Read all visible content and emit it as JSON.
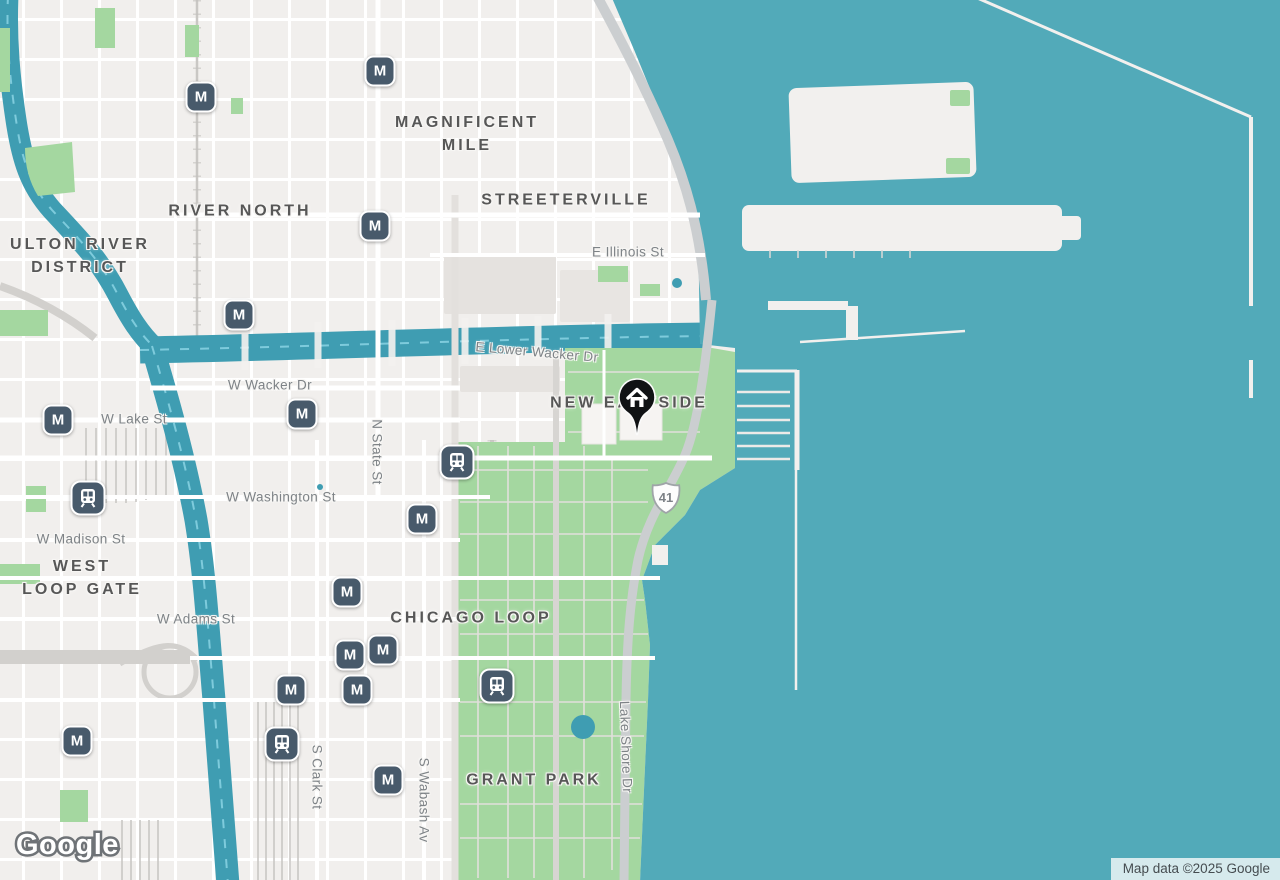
{
  "map": {
    "watermark": "Google",
    "attribution": "Map data ©2025 Google",
    "route_shield": "41",
    "icons": {
      "metro_glyph": "M"
    },
    "labels": {
      "neighborhoods": [
        {
          "text": "MAGNIFICENT\nMILE"
        },
        {
          "text": "RIVER NORTH"
        },
        {
          "text": "ULTON RIVER\nDISTRICT"
        },
        {
          "text": "STREETERVILLE"
        },
        {
          "text": "NEW EASTSIDE"
        },
        {
          "text": "WEST\nLOOP GATE"
        },
        {
          "text": "CHICAGO LOOP"
        },
        {
          "text": "GRANT PARK"
        }
      ],
      "streets": [
        {
          "text": "E Illinois St"
        },
        {
          "text": "E Lower Wacker Dr"
        },
        {
          "text": "W Wacker Dr"
        },
        {
          "text": "W Lake St"
        },
        {
          "text": "N State St"
        },
        {
          "text": "W Washington St"
        },
        {
          "text": "W Madison St"
        },
        {
          "text": "W Adams St"
        },
        {
          "text": "S Clark St"
        },
        {
          "text": "S Wabash Av"
        },
        {
          "text": "Lake Shore Dr"
        }
      ]
    },
    "colors": {
      "water": "#52aab9",
      "river": "#3f9db2",
      "river_dash": "#7ecbdc",
      "park": "#a4d7a0",
      "land": "#f1efed",
      "road_gray": "#cbced0",
      "transit_icon": "#485a6b"
    }
  }
}
